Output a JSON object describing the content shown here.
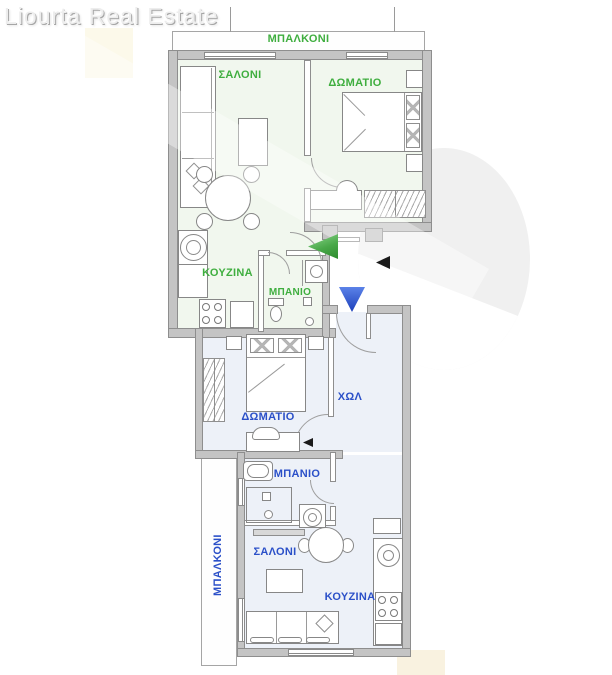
{
  "title": "Liourta Real Estate",
  "plan": {
    "upper_apartment": {
      "balcony_label": "ΜΠΑΛΚΟΝΙ",
      "living_room_label": "ΣΑΛΟΝΙ",
      "bedroom_label": "ΔΩΜΑΤΙΟ",
      "kitchen_label": "ΚΟΥΖΙΝΑ",
      "bathroom_label": "ΜΠΑΝΙΟ",
      "accent_color": "#3fae3f"
    },
    "lower_apartment": {
      "hall_label": "ΧΩΛ",
      "bedroom_label": "ΔΩΜΑΤΙΟ",
      "bathroom_label": "ΜΠΑΝΙΟ",
      "living_room_label": "ΣΑΛΟΝΙ",
      "kitchen_label": "ΚΟΥΖΙΝΑ",
      "balcony_label": "ΜΠΑΛΚΟΝΙ",
      "accent_color": "#2b50c8"
    },
    "markers": {
      "upper_entrance": "green-arrow-left",
      "lower_entrance": "blue-arrow-down",
      "common_direction": "black-arrow-left"
    },
    "colors": {
      "wall": "#c4c4c4",
      "upper_floor": "#f1f7ee",
      "lower_floor": "#edf1f8"
    }
  }
}
